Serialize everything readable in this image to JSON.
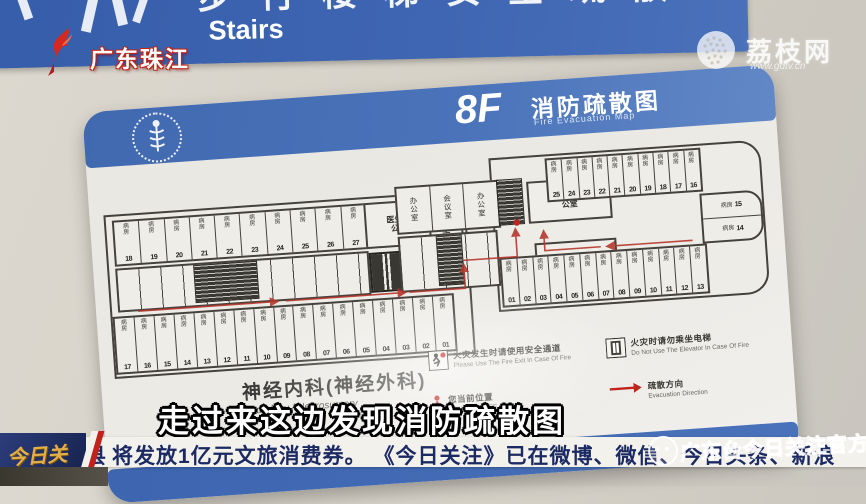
{
  "overlay": {
    "channel_logo": "广东珠江",
    "site_logo": "荔枝网",
    "site_url": "www.gdtv.cn",
    "subtitle": "走过来这边发现消防疏散图",
    "ticker": {
      "program_logo": "今日关注",
      "lead_partial": "县",
      "text": "将发放1亿元文旅消费券。 《今日关注》已在微博、微信、今日头条、新浪",
      "watermark": "广东台今日关注官方"
    }
  },
  "stairs_sign": {
    "cn_partial": "步行楼梯安全疏散",
    "en": "Stairs"
  },
  "evac_sign": {
    "floor": "8F",
    "title": "消防疏散图",
    "title_en": "Fire Evacuation Map",
    "department": "神经内科(神经外科)",
    "department_en": "Neurology / Neurosurgery",
    "legend": [
      {
        "icon": "fire-exit",
        "cn": "火灾发生时请使用安全通道",
        "en": "Please Use The Fire Exit In Case Of Fire"
      },
      {
        "icon": "no-elevator",
        "cn": "火灾时请勿乘坐电梯",
        "en": "Do Not Use The Elevator In Case Of Fire"
      },
      {
        "icon": "you-are-here",
        "cn": "您当前位置",
        "en": "YOU ARE HERE"
      },
      {
        "icon": "evac-direction",
        "cn": "疏散方向",
        "en": "Evacuation Direction"
      }
    ],
    "floorplan": {
      "ward_label": "病房",
      "left_top_wards": [
        "18",
        "19",
        "20",
        "21",
        "22",
        "23",
        "24",
        "25",
        "26",
        "27"
      ],
      "left_doctor_office": "医生办公室",
      "left_meeting_room": "会议室",
      "left_bottom_wards": [
        "17",
        "16",
        "15",
        "14",
        "13",
        "12",
        "11",
        "10",
        "09",
        "08",
        "07",
        "06",
        "05",
        "04",
        "03",
        "02",
        "01"
      ],
      "center_rooms": [
        "办公室",
        "会议室",
        "办公室"
      ],
      "center_doctor_office": "医生办公室",
      "center_office": "办公室",
      "right_top_wards": [
        "25",
        "24",
        "23",
        "22",
        "21",
        "20",
        "19",
        "18",
        "17",
        "16"
      ],
      "right_end_wards": [
        "15",
        "14"
      ],
      "right_bottom_wards": [
        "01",
        "02",
        "03",
        "04",
        "05",
        "06",
        "07",
        "08",
        "09",
        "10",
        "11",
        "12",
        "13"
      ]
    }
  }
}
